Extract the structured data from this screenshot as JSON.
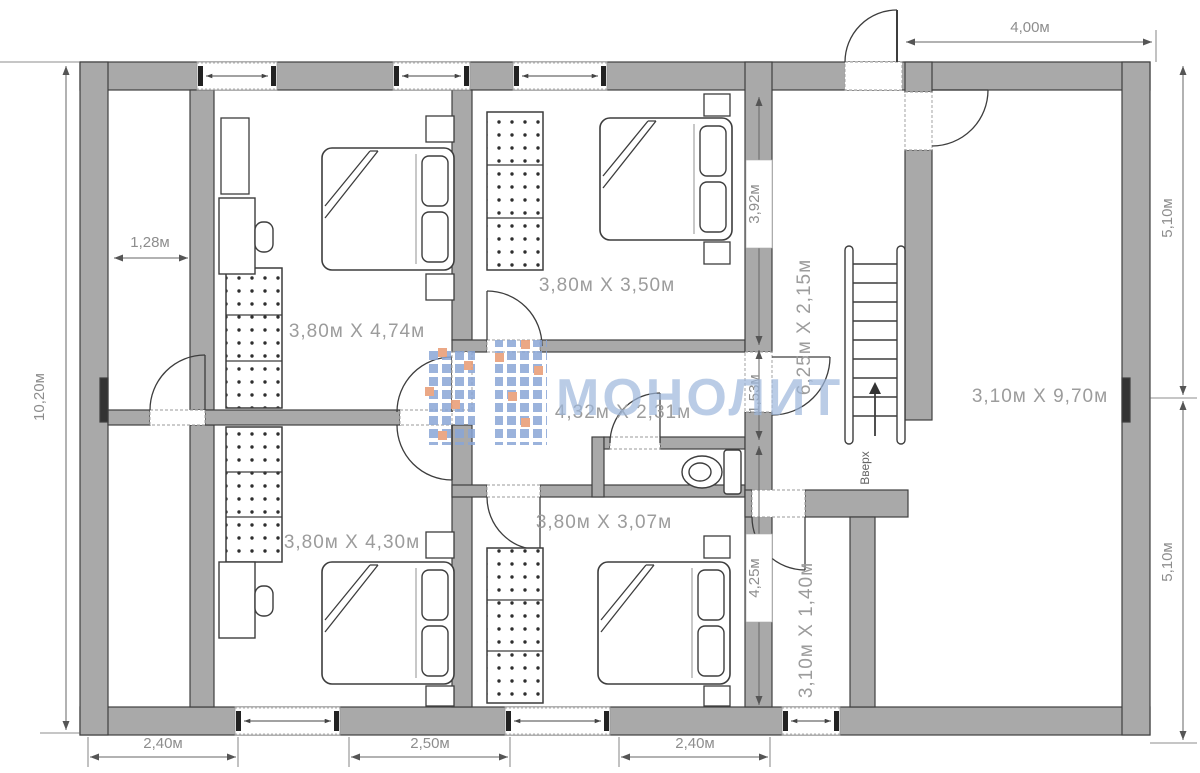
{
  "watermark": {
    "text": "МОНОЛИТ"
  },
  "rooms": [
    {
      "id": "bedroom-top-left",
      "label": "3,80м X 4,74м"
    },
    {
      "id": "bedroom-top-right",
      "label": "3,80м X 3,50м"
    },
    {
      "id": "bedroom-bottom-left",
      "label": "3,80м X 4,30м"
    },
    {
      "id": "bedroom-bottom-right",
      "label": "3,80м X 3,07м"
    },
    {
      "id": "hallway",
      "label": "4,32м X 2,31м"
    },
    {
      "id": "stair-hall",
      "label": "6,25м X 2,15м"
    },
    {
      "id": "living-room",
      "label": "3,10м X 9,70м"
    },
    {
      "id": "entry-room",
      "label": "3,10м X 1,40м"
    }
  ],
  "stairs": {
    "label": "Вверх"
  },
  "dimensions": {
    "top": "4,00м",
    "left_total": "10,20м",
    "closet_width": "1,28м",
    "seg_392": "3,92м",
    "seg_153": "1,53м",
    "seg_425": "4,25м",
    "right_upper": "5,10м",
    "right_lower": "5,10м",
    "bottom_left": "2,40м",
    "bottom_middle": "2,50м",
    "bottom_right": "2,40м"
  },
  "colors": {
    "wall": "#a9a9a9",
    "dim_text": "#8d8d8d",
    "room_text": "#9c9c9c",
    "watermark_text": "#9db6db",
    "logo_blue": "#8aa6d6",
    "logo_orange": "#e89a72"
  }
}
